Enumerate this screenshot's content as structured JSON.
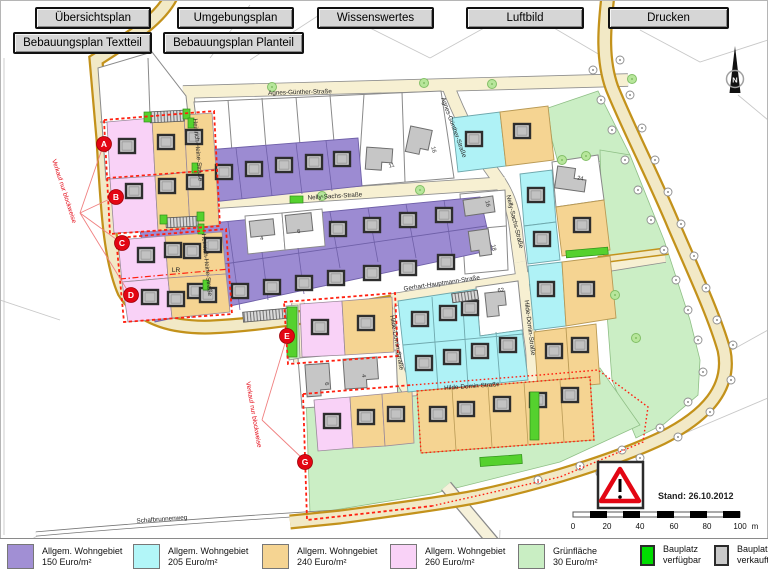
{
  "toolbar": {
    "row1": [
      "Übersichtsplan",
      "Umgebungsplan",
      "Wissenswertes",
      "Luftbild",
      "Drucken"
    ],
    "row2": [
      "Bebauungsplan Textteil",
      "Bebauungsplan Planteil"
    ]
  },
  "map": {
    "streets": {
      "agnes_guenther": "Agnes-Günther-Straße",
      "heinrich_heine": "Heinrich-Heine-Straße",
      "nelly_sachs": "Nelly-Sachs-Straße",
      "gerhart_hauptmann": "Gerhart-Hauptmann-Straße",
      "hilde_domin": "Hilde-Domin-Straße",
      "schafbrunnenweg": "Schafbrunnenweg"
    },
    "blocks": {
      "a": "A",
      "b": "B",
      "c": "C",
      "d": "D",
      "e": "E",
      "g": "G"
    },
    "sale_note": "Verkauf nur blockweise",
    "lr": "LR",
    "north": "N",
    "houses": {
      "h11": "11",
      "h16": "16",
      "h4": "4",
      "h6": "6",
      "h16b": "16",
      "h18": "18",
      "h24": "24",
      "h62": "62",
      "h6b": "6",
      "h4b": "4"
    },
    "stand": "Stand: 26.10.2012",
    "scale": {
      "ticks": [
        "0",
        "20",
        "40",
        "60",
        "80",
        "100"
      ],
      "unit": "m"
    }
  },
  "legend": {
    "items": [
      {
        "line1": "Allgem. Wohngebiet",
        "line2": "150 Euro/m²",
        "color": "#a18fd4",
        "type": "area"
      },
      {
        "line1": "Allgem. Wohngebiet",
        "line2": "205 Euro/m²",
        "color": "#b2f6f8",
        "type": "area"
      },
      {
        "line1": "Allgem. Wohngebiet",
        "line2": "240 Euro/m²",
        "color": "#f5d492",
        "type": "area"
      },
      {
        "line1": "Allgem. Wohngebiet",
        "line2": "260 Euro/m²",
        "color": "#f9d2f7",
        "type": "area"
      },
      {
        "line1": "Grünfläche",
        "line2": "30 Euro/m²",
        "color": "#c9eec3",
        "type": "area"
      },
      {
        "line1": "Bauplatz",
        "line2": "verfügbar",
        "color": "#00dd00",
        "type": "plot"
      },
      {
        "line1": "Bauplatz",
        "line2": "verkauft",
        "color": "#c9c9c9",
        "type": "plot"
      }
    ]
  },
  "colors": {
    "road_casing": "#c3921b",
    "road_fill": "#f2e9c6",
    "street_fill": "#f7f0d2",
    "red": "#e30613",
    "purple": "#9c8bd2",
    "cyan": "#aff2f6",
    "orange": "#f5d492",
    "pink": "#f9d2f7",
    "green": "#cbeec5",
    "sold_plot": "#cccccc",
    "avail_plot": "#00dd00"
  }
}
